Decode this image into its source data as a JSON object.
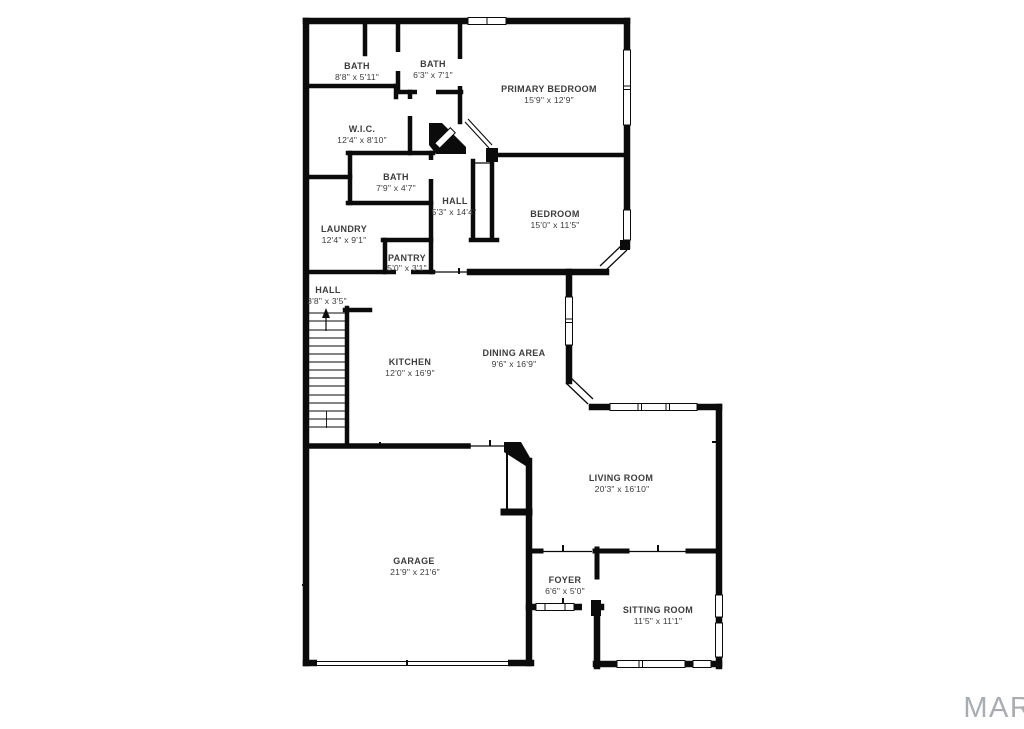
{
  "watermark": "MARIS",
  "colors": {
    "wall": "#0b0b0b",
    "label": "#3c3c3c",
    "watermark": "#a8adb3"
  },
  "rooms": {
    "bath1": {
      "name": "BATH",
      "dims": "8'8\" x 5'11\""
    },
    "bath2": {
      "name": "BATH",
      "dims": "6'3\" x 7'1\""
    },
    "primary": {
      "name": "PRIMARY BEDROOM",
      "dims": "15'9\" x 12'9\""
    },
    "wic": {
      "name": "W.I.C.",
      "dims": "12'4\" x 8'10\""
    },
    "bath3": {
      "name": "BATH",
      "dims": "7'9\" x 4'7\""
    },
    "hall1": {
      "name": "HALL",
      "dims": "5'3\" x 14'4\""
    },
    "bedroom": {
      "name": "BEDROOM",
      "dims": "15'0\" x 11'5\""
    },
    "laundry": {
      "name": "LAUNDRY",
      "dims": "12'4\" x 9'1\""
    },
    "pantry": {
      "name": "PANTRY",
      "dims": "5'0\" x 3'1\""
    },
    "hall2": {
      "name": "HALL",
      "dims": "3'8\" x 3'5\""
    },
    "kitchen": {
      "name": "KITCHEN",
      "dims": "12'0\" x 16'9\""
    },
    "dining": {
      "name": "DINING AREA",
      "dims": "9'6\" x 16'9\""
    },
    "living": {
      "name": "LIVING ROOM",
      "dims": "20'3\" x 16'10\""
    },
    "garage": {
      "name": "GARAGE",
      "dims": "21'9\" x 21'6\""
    },
    "foyer": {
      "name": "FOYER",
      "dims": "6'6\" x 5'0\""
    },
    "sitting": {
      "name": "SITTING ROOM",
      "dims": "11'5\" x 11'1\""
    }
  }
}
